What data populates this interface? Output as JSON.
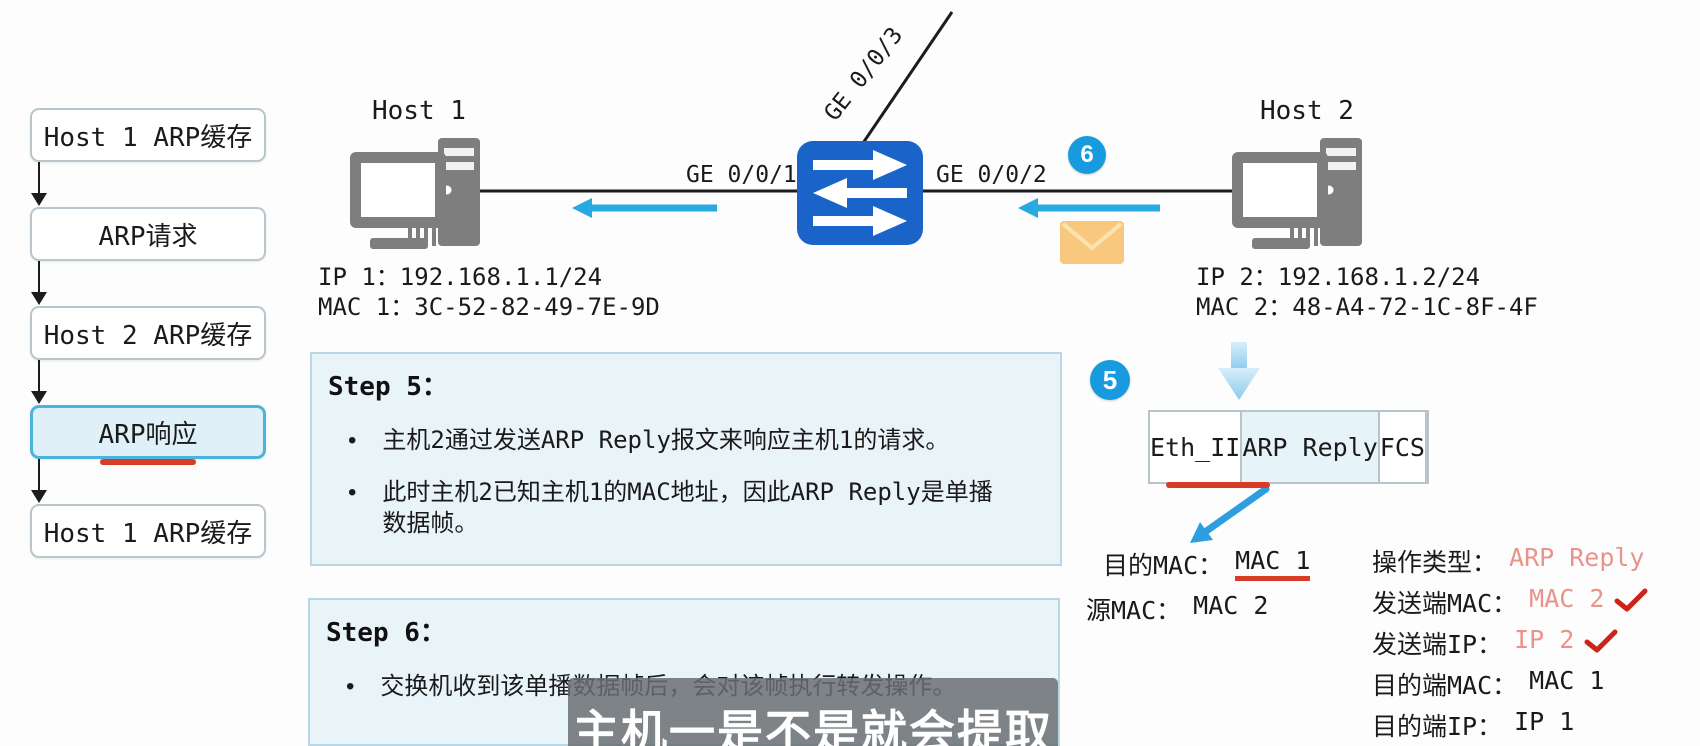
{
  "flowchart": {
    "steps": [
      {
        "label": "Host 1 ARP缓存",
        "highlighted": false
      },
      {
        "label": "ARP请求",
        "highlighted": false
      },
      {
        "label": "Host 2 ARP缓存",
        "highlighted": false
      },
      {
        "label": "ARP响应",
        "highlighted": true
      },
      {
        "label": "Host 1 ARP缓存",
        "highlighted": false
      }
    ]
  },
  "topology": {
    "host1": {
      "name": "Host 1",
      "ip": "IP 1：192.168.1.1/24",
      "mac": "MAC 1：3C-52-82-49-7E-9D"
    },
    "host2": {
      "name": "Host 2",
      "ip": "IP 2：192.168.1.2/24",
      "mac": "MAC 2：48-A4-72-1C-8F-4F"
    },
    "switch_ports": {
      "port1": "GE 0/0/1",
      "port2": "GE 0/0/2",
      "port3": "GE 0/0/3"
    },
    "step_badges": {
      "at_link": "6",
      "at_frame": "5"
    }
  },
  "steps": [
    {
      "title": "Step 5：",
      "bullets": [
        "主机2通过发送ARP Reply报文来响应主机1的请求。",
        "此时主机2已知主机1的MAC地址，因此ARP Reply是单播数据帧。"
      ]
    },
    {
      "title": "Step 6：",
      "bullets": [
        "交换机收到该单播数据帧后，会对该帧执行转发操作。"
      ]
    }
  ],
  "frame": {
    "fields": [
      {
        "label": "Eth_II",
        "tinted": false
      },
      {
        "label": "ARP Reply",
        "tinted": true
      },
      {
        "label": "FCS",
        "tinted": false
      }
    ]
  },
  "eth_header_fields": [
    {
      "label": "目的MAC：",
      "value": "MAC 1",
      "underlined": true
    },
    {
      "label": "源MAC：",
      "value": "MAC 2",
      "underlined": false
    }
  ],
  "arp_payload_fields": [
    {
      "label": "操作类型：",
      "value": "ARP Reply",
      "emphasis": true,
      "checked": false
    },
    {
      "label": "发送端MAC：",
      "value": "MAC 2",
      "emphasis": true,
      "checked": true
    },
    {
      "label": "发送端IP：",
      "value": "IP 2",
      "emphasis": true,
      "checked": true
    },
    {
      "label": "目的端MAC：",
      "value": "MAC 1",
      "emphasis": false,
      "checked": false
    },
    {
      "label": "目的端IP：",
      "value": "IP 1",
      "emphasis": false,
      "checked": false
    }
  ],
  "subtitle": "主机一是不是就会提取",
  "colors": {
    "switch_blue": "#1a63c8",
    "badge_blue": "#189ade",
    "arrow_cyan": "#29a9e1",
    "highlight_red": "#d63c26",
    "check_red": "#cd241a",
    "emphasis_salmon": "#ea938a",
    "step_box_bg": "#e9f4f9",
    "flow_highlight_bg": "#dff0f8",
    "flow_highlight_border": "#4cb4da",
    "envelope_orange": "#f7c87d",
    "icon_gray": "#7e7e7e",
    "subtitle_bg": "#6a6e72"
  }
}
